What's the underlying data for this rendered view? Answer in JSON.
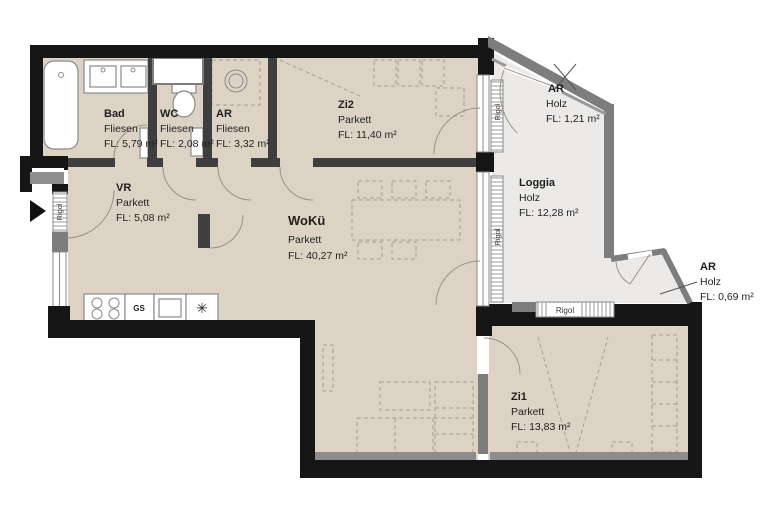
{
  "plan": {
    "kind": "apartment floor plan"
  },
  "rooms": [
    {
      "key": "bad",
      "name": "Bad",
      "material": "Fliesen",
      "area": "FL: 5,79 m²"
    },
    {
      "key": "wc",
      "name": "WC",
      "material": "Fliesen",
      "area": "FL: 2,08 m²"
    },
    {
      "key": "ar-top",
      "name": "AR",
      "material": "Fliesen",
      "area": "FL: 3,32 m²"
    },
    {
      "key": "zi2",
      "name": "Zi2",
      "material": "Parkett",
      "area": "FL: 11,40 m²"
    },
    {
      "key": "vr",
      "name": "VR",
      "material": "Parkett",
      "area": "FL: 5,08 m²"
    },
    {
      "key": "woku",
      "name": "WoKü",
      "material": "Parkett",
      "area": "FL: 40,27 m²"
    },
    {
      "key": "ar-loggia",
      "name": "AR",
      "material": "Holz",
      "area": "FL: 1,21 m²"
    },
    {
      "key": "loggia",
      "name": "Loggia",
      "material": "Holz",
      "area": "FL: 12,28 m²"
    },
    {
      "key": "ar-east",
      "name": "AR",
      "material": "Holz",
      "area": "FL: 0,69 m²"
    },
    {
      "key": "zi1",
      "name": "Zi1",
      "material": "Parkett",
      "area": "FL: 13,83 m²"
    }
  ],
  "annotations": {
    "rigol": "Rigol",
    "dishwasher": "GS",
    "freezer_symbol": "✳"
  },
  "colors": {
    "floor": "#ddd3c5",
    "loggia_floor": "#ebeae8",
    "wall": "#161616",
    "partition": "#3f3f3f",
    "gray_wall": "#7d7d7d"
  }
}
